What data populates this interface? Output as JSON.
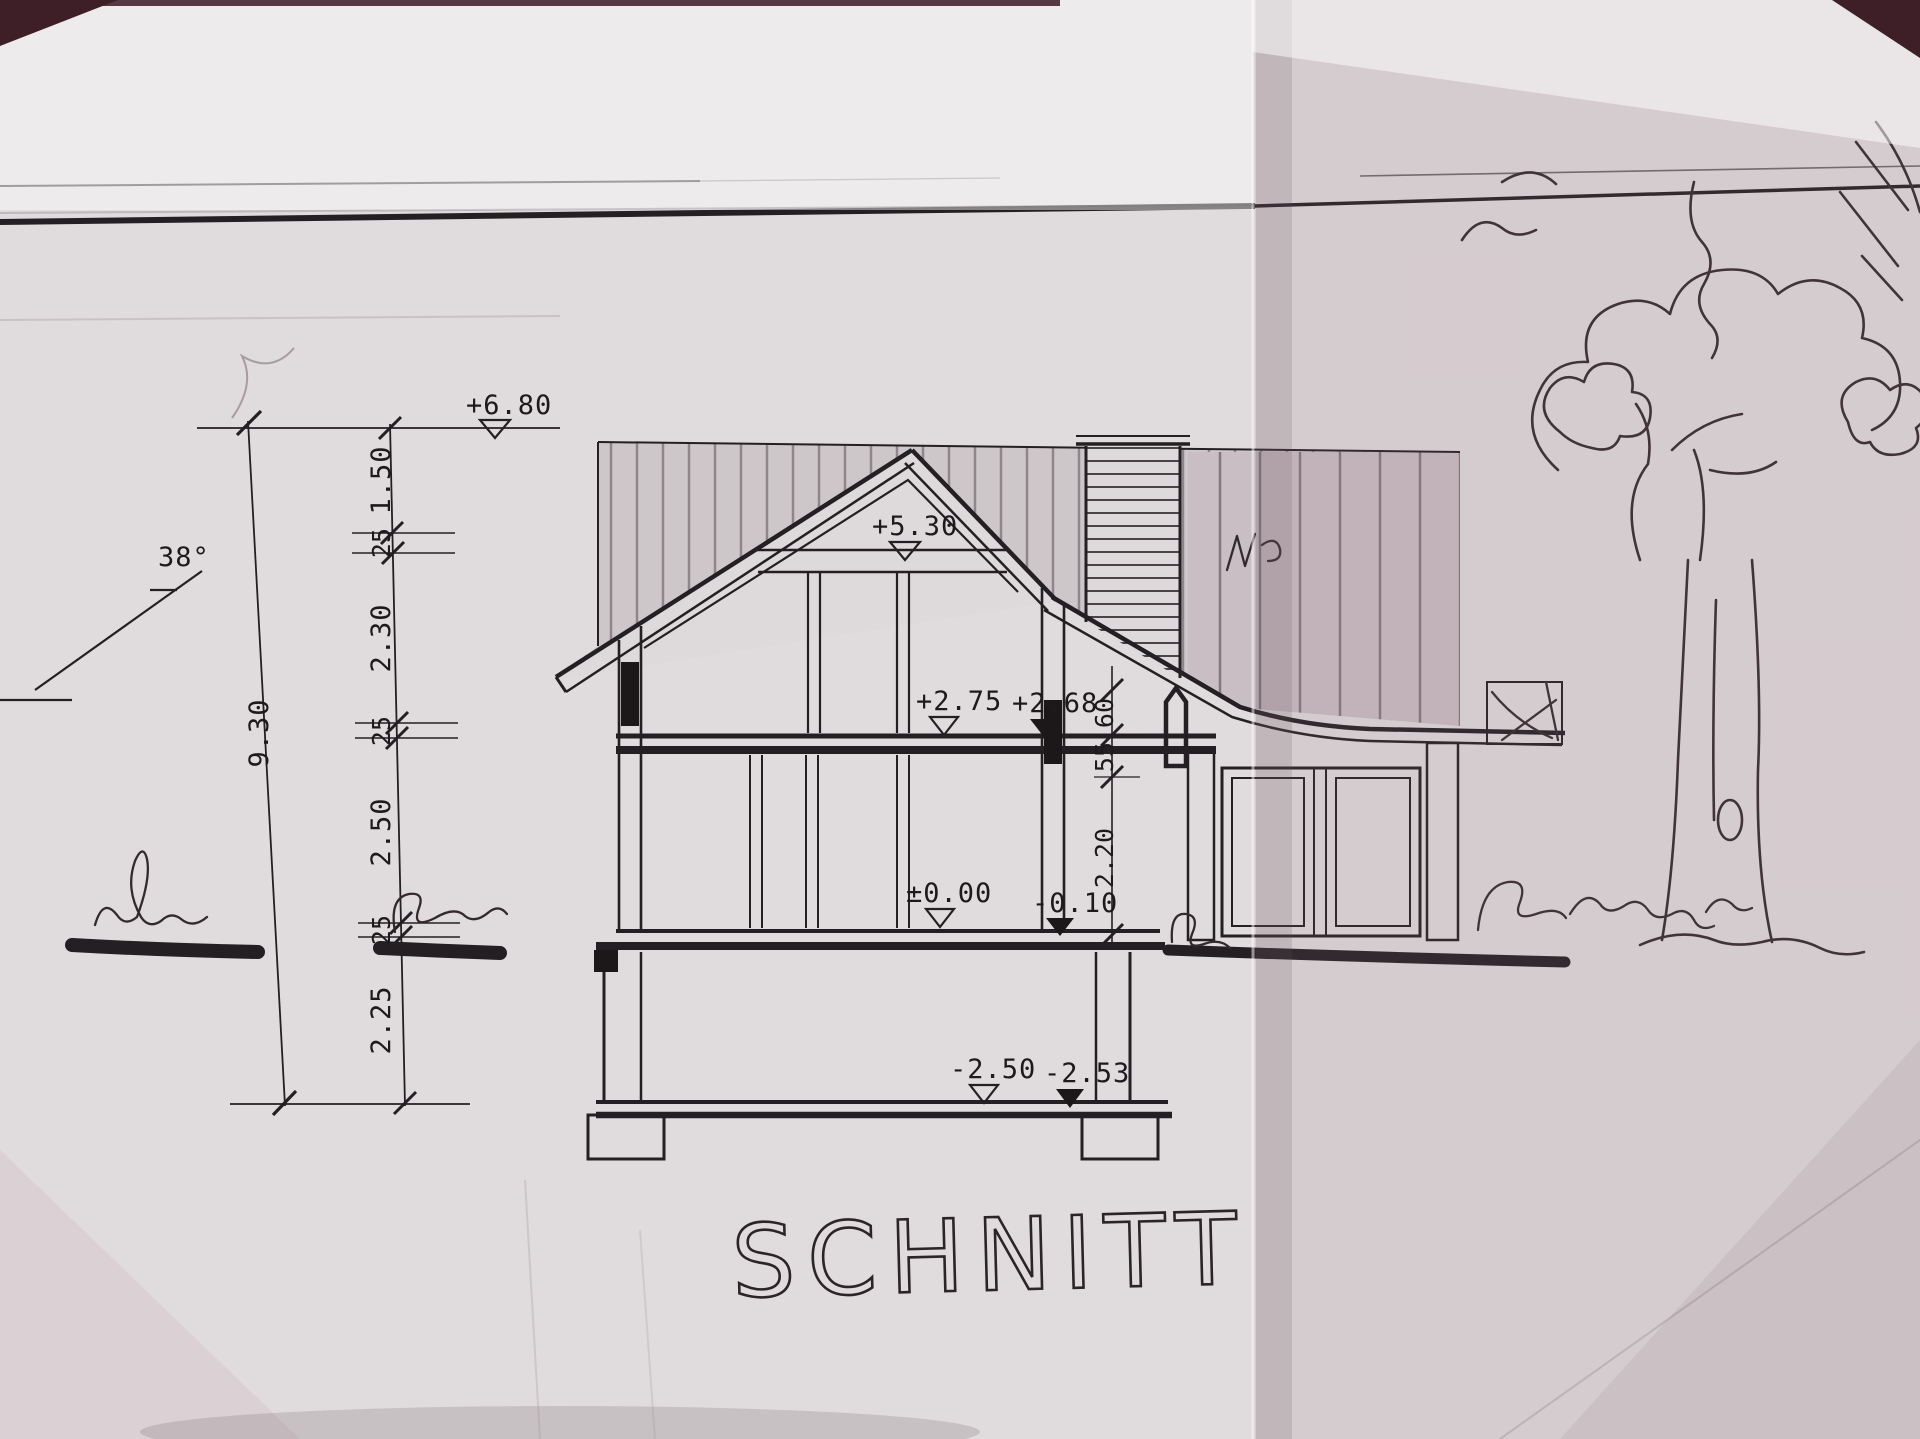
{
  "drawing": {
    "title": "SCHNITT",
    "roof_angle": "38°",
    "elevations": {
      "ridge_top": "+6.80",
      "gable": "+5.30",
      "attic_floor_raw": "+2.75",
      "attic_floor_finished": "+2.68",
      "ground_floor": "±0.00",
      "terrain": "-0.10",
      "basement_floor": "-2.50",
      "basement_slab": "-2.53"
    },
    "left_dimension_chain": {
      "total": "9.30",
      "segments": [
        "1.50",
        "25",
        "2.30",
        "25",
        "2.50",
        "25",
        "2.25"
      ]
    },
    "right_dimension_chain": {
      "segments": [
        "60",
        "55",
        "2.20"
      ]
    },
    "colors": {
      "ink": "#241f22",
      "paper": "#e0dbdd",
      "paper_fold_right": "#cbbec4",
      "table_edge": "#3f1f27"
    }
  }
}
